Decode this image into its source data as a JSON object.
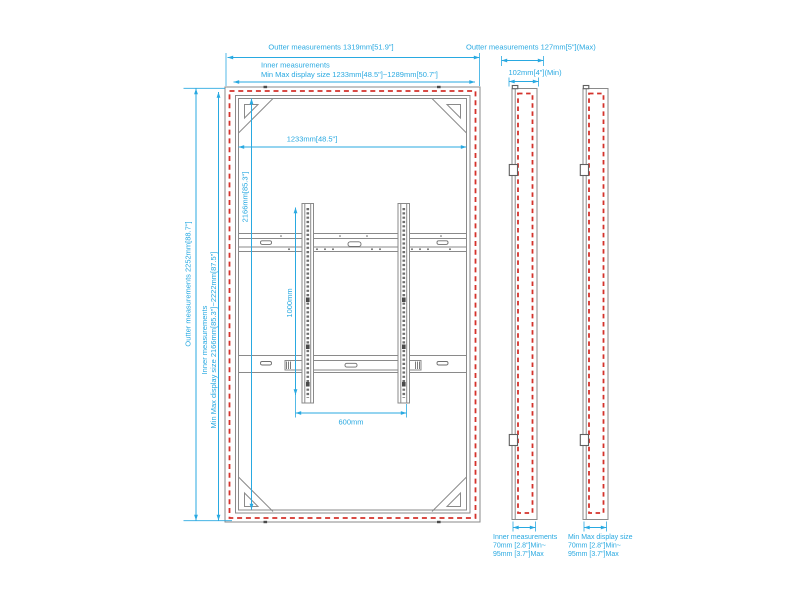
{
  "colors": {
    "dimension_accent": "#29a9e1",
    "display_outline_red": "#d4322b",
    "frame_gray": "#8a8a8a"
  },
  "front_view": {
    "top": {
      "outer_label": "Outter measurements 1319mm[51.9\"]",
      "inner_title": "Inner measurements",
      "inner_label": "Min Max display size 1233mm[48.5\"]~1289mm[50.7\"]"
    },
    "left": {
      "outer_label": "Outter measurements 2252mm[88.7\"]",
      "inner_title": "Inner measurements",
      "inner_label": "Min Max display size 2166mm[85.3\"]~2222mm[87.5\"]"
    },
    "inner_width_label": "1233mm[48.5\"]",
    "inner_height_label": "2166mm[85.3\"]",
    "mount": {
      "hole_height_label": "1000mm",
      "hole_width_label": "600mm"
    }
  },
  "side_views": {
    "top": {
      "outer_label": "Outter measurements 127mm[5\"](Max)",
      "min_label": "102mm[4\"](Min)"
    },
    "bottom_left": {
      "title": "Inner measurements",
      "line1": "70mm [2.8\"]Min~",
      "line2": "95mm [3.7\"]Max"
    },
    "bottom_right": {
      "title": "Min Max display size",
      "line1": "70mm [2.8\"]Min~",
      "line2": "95mm [3.7\"]Max"
    }
  }
}
